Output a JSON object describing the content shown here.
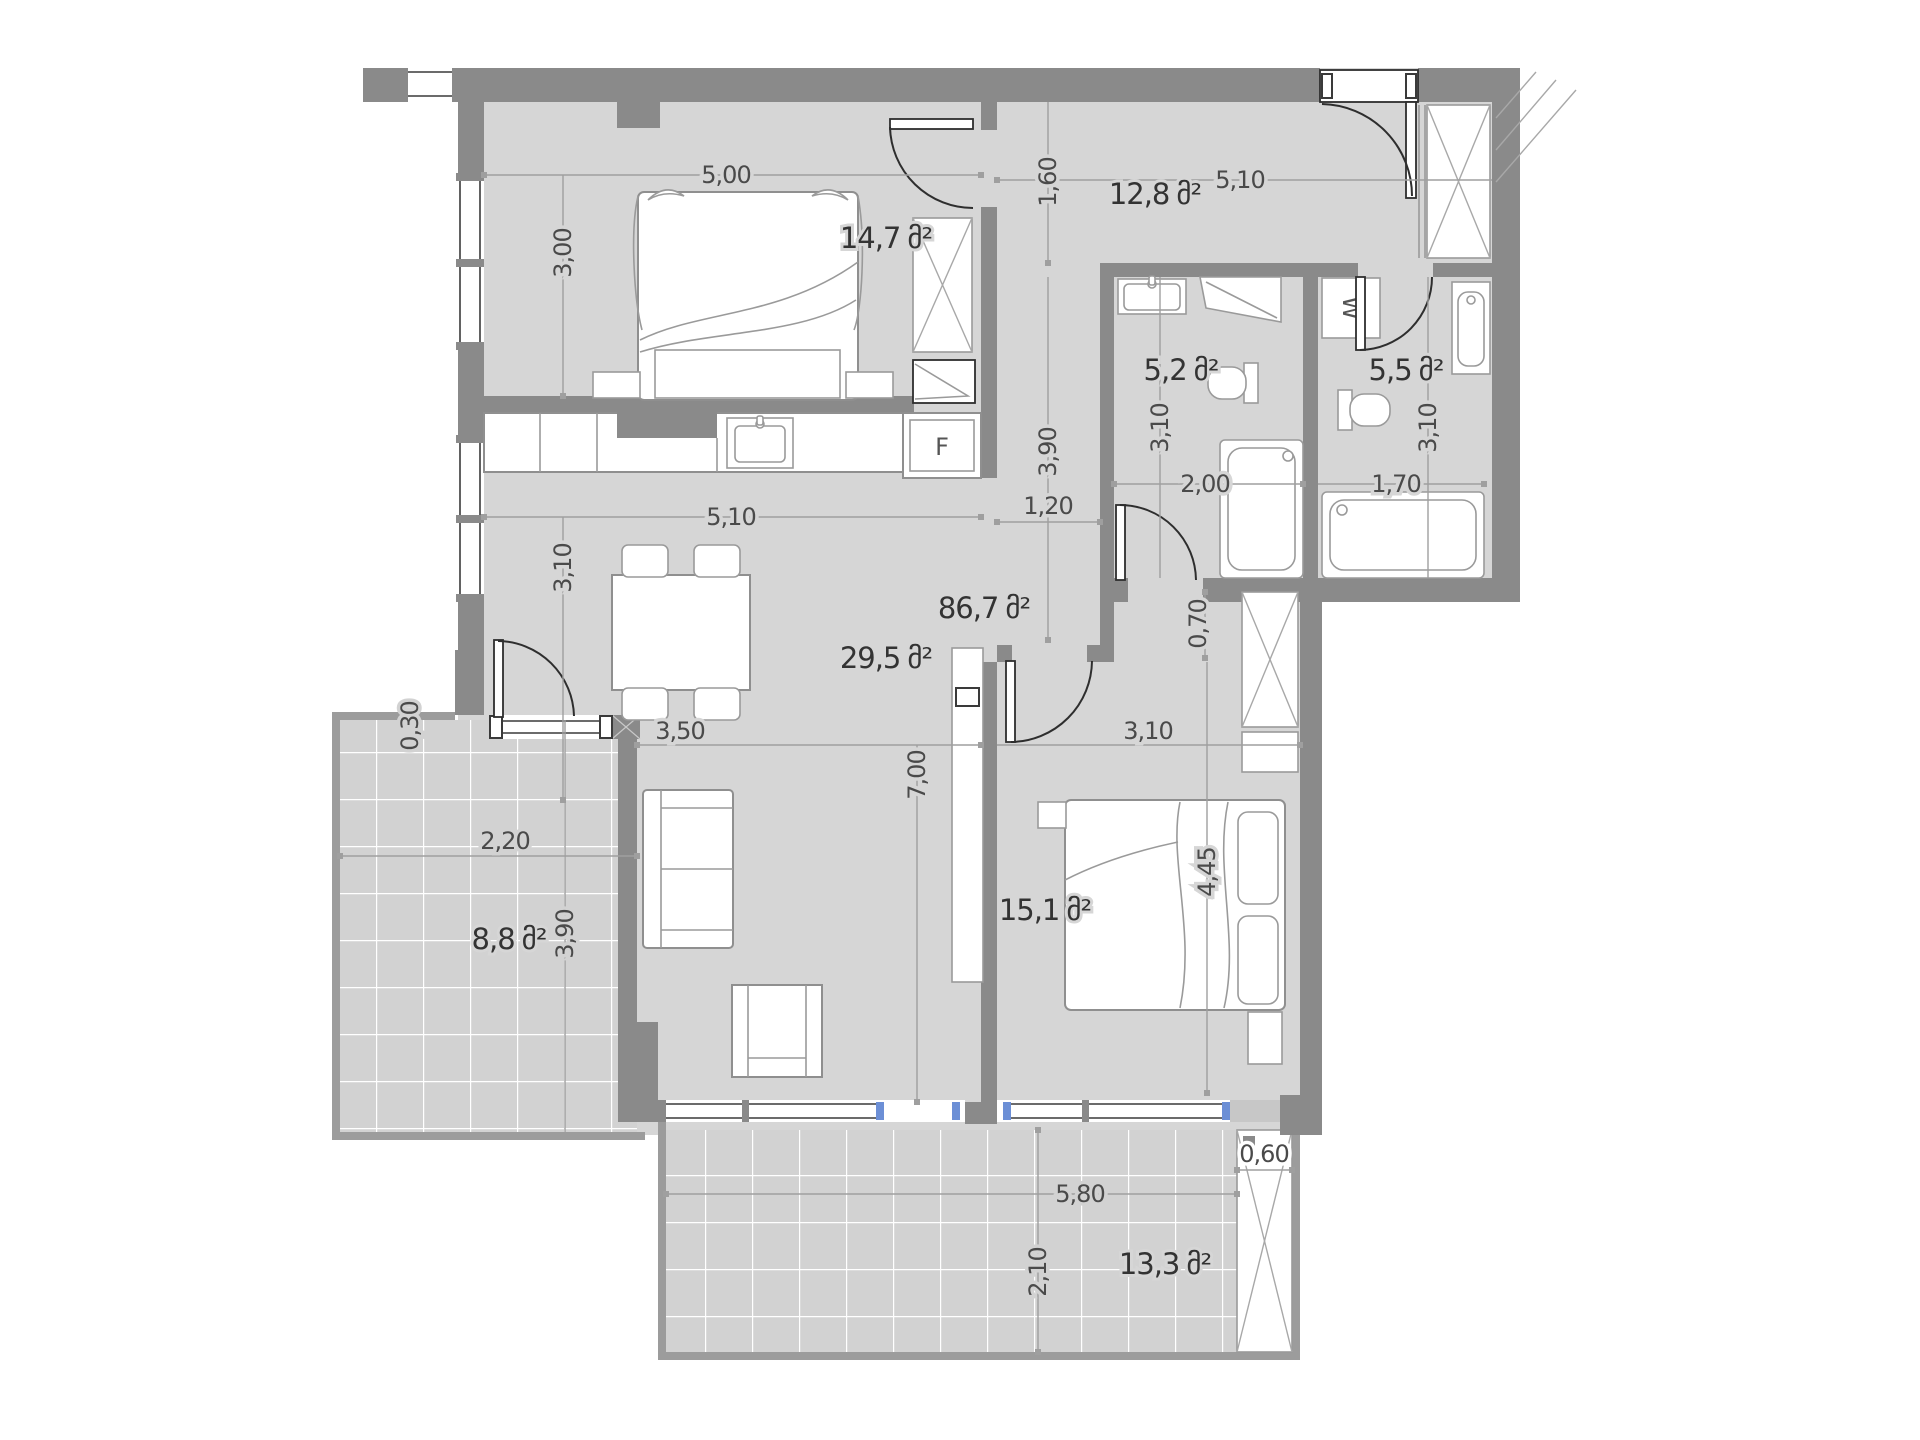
{
  "unit": "მ²",
  "apartment": {
    "total_area": "86,7"
  },
  "rooms": {
    "bedroom1": {
      "area": "14,7",
      "width": "5,00",
      "depth": "3,00"
    },
    "hall": {
      "area": "12,8",
      "width": "5,10",
      "depth": "1,60"
    },
    "corridor": {
      "length": "3,90",
      "width": "1,20"
    },
    "bathroom1": {
      "area": "5,2",
      "width": "2,00",
      "depth": "3,10"
    },
    "bathroom2": {
      "area": "5,5",
      "width": "1,70",
      "depth": "3,10"
    },
    "living": {
      "area": "29,5",
      "kitchen_width": "5,10",
      "upper_depth": "3,10",
      "width": "3,50",
      "length": "7,00"
    },
    "bedroom2": {
      "area": "15,1",
      "width": "3,10",
      "length": "4,45",
      "niche_depth": "0,70"
    },
    "balcony_left": {
      "area": "8,8",
      "width": "2,20",
      "length": "3,90",
      "edge": "0,30"
    },
    "balcony_bottom": {
      "area": "13,3",
      "width": "5,80",
      "depth": "2,10",
      "shaft_width": "0,60"
    }
  },
  "appliances": {
    "fridge": "F",
    "washer": "W"
  }
}
